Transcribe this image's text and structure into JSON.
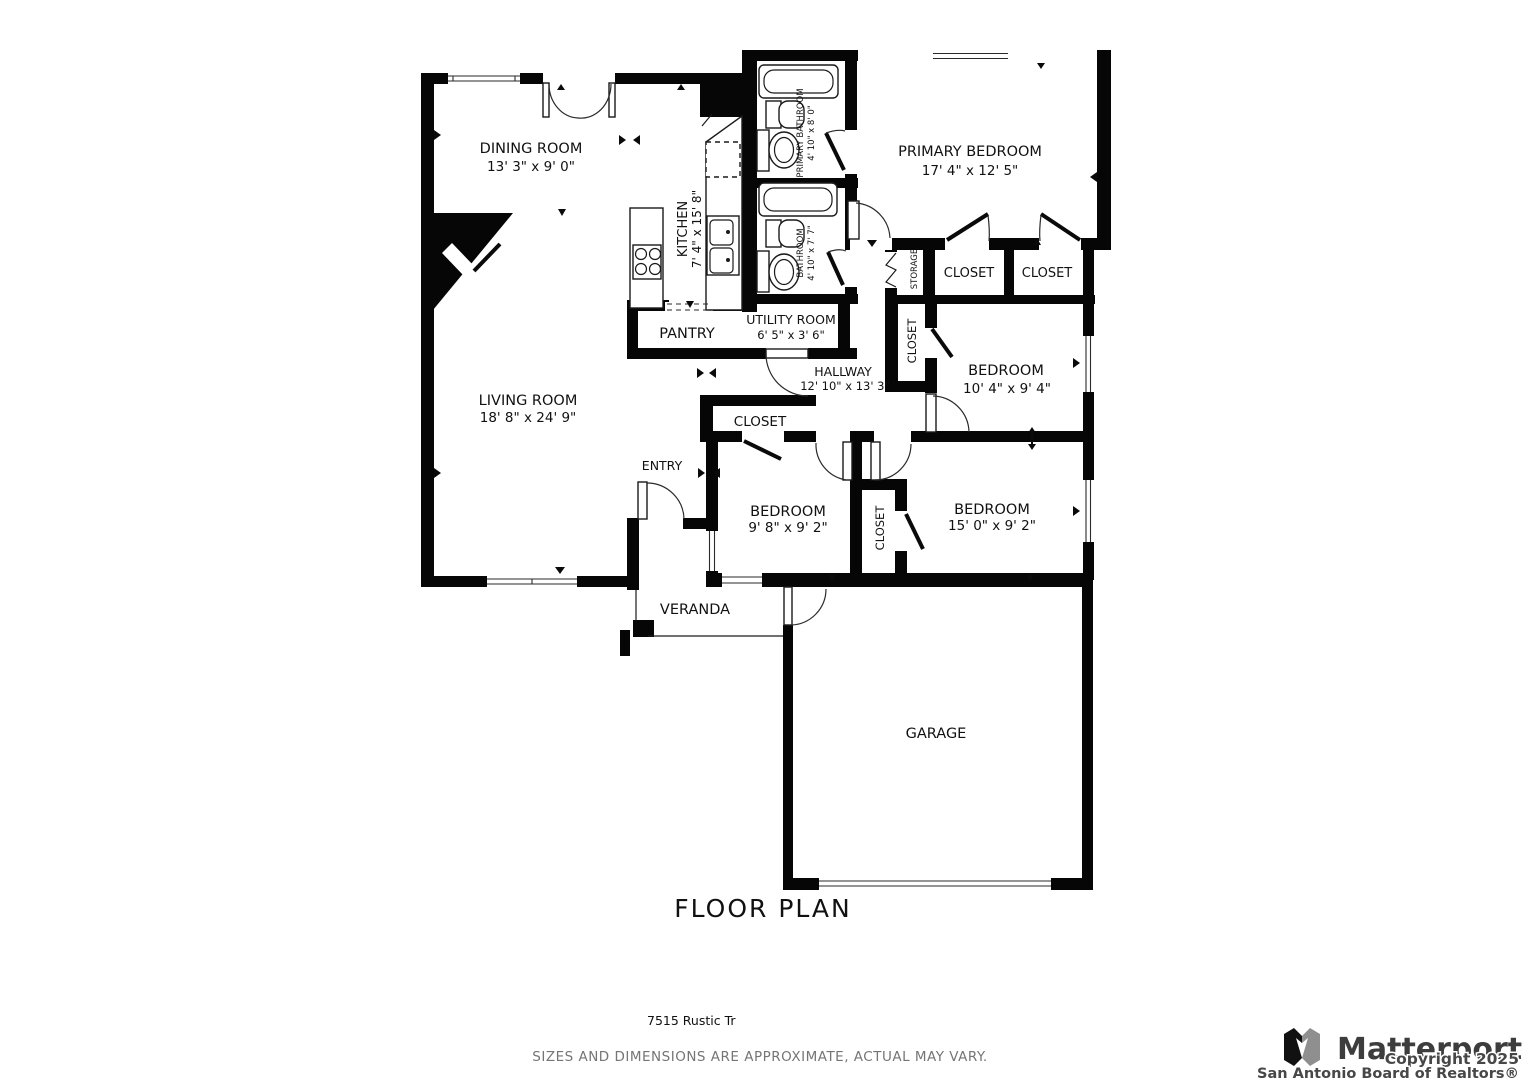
{
  "title": "FLOOR PLAN",
  "address": "7515 Rustic Tr",
  "disclaimer": "SIZES AND DIMENSIONS ARE APPROXIMATE, ACTUAL MAY VARY.",
  "branding": {
    "logo": "Matterport",
    "copyright": "Copyright 2025",
    "attribution": "San Antonio Board of Realtors®"
  },
  "colors": {
    "walls": "#060606",
    "label_text": "#111111",
    "muted_text": "#757575",
    "logo_gray": "#3d3d3d"
  },
  "rooms": {
    "dining": {
      "name": "DINING ROOM",
      "dims": "13' 3\" x 9' 0\""
    },
    "kitchen": {
      "name": "KITCHEN",
      "dims": "7' 4\" x 15' 8\""
    },
    "primary_bathroom": {
      "name": "PRIMARY BATHROOM",
      "dims": "4' 10\" x 8' 0\""
    },
    "bathroom": {
      "name": "BATHROOM",
      "dims": "4' 10\" x 7' 7\""
    },
    "primary_bedroom": {
      "name": "PRIMARY BEDROOM",
      "dims": "17' 4\" x 12' 5\""
    },
    "storage": {
      "name": "STORAGE"
    },
    "closet_primary_left": {
      "name": "CLOSET"
    },
    "closet_primary_right": {
      "name": "CLOSET"
    },
    "utility": {
      "name": "UTILITY ROOM",
      "dims": "6' 5\" x 3' 6\""
    },
    "pantry": {
      "name": "PANTRY"
    },
    "hallway": {
      "name": "HALLWAY",
      "dims": "12' 10\" x 13' 3\""
    },
    "closet_hallway": {
      "name": "CLOSET"
    },
    "bedroom2": {
      "name": "BEDROOM",
      "dims": "10' 4\" x 9' 4\""
    },
    "living": {
      "name": "LIVING ROOM",
      "dims": "18' 8\" x 24' 9\""
    },
    "closet_entry": {
      "name": "CLOSET"
    },
    "entry": {
      "name": "ENTRY"
    },
    "bedroom3": {
      "name": "BEDROOM",
      "dims": "9' 8\" x 9' 2\""
    },
    "closet_bedrooms": {
      "name": "CLOSET"
    },
    "bedroom4": {
      "name": "BEDROOM",
      "dims": "15' 0\" x 9' 2\""
    },
    "veranda": {
      "name": "VERANDA"
    },
    "garage": {
      "name": "GARAGE"
    }
  }
}
